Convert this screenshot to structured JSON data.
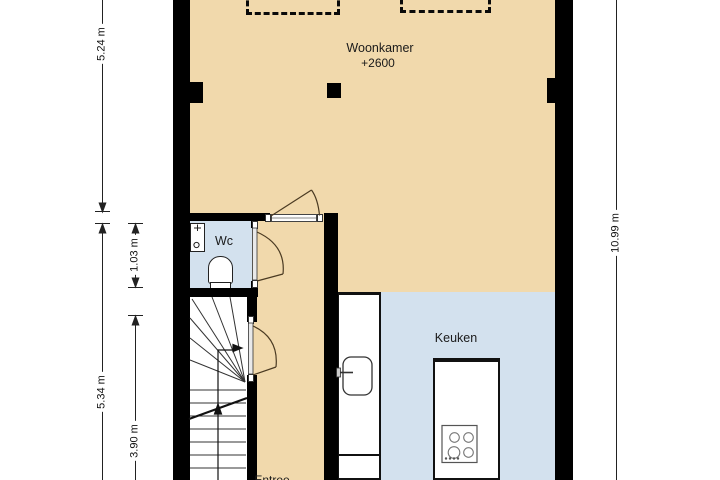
{
  "plan": {
    "rooms": {
      "woonkamer": {
        "label": "Woonkamer",
        "level_height": "+2600"
      },
      "wc": {
        "label": "Wc"
      },
      "keuken": {
        "label": "Keuken"
      },
      "entree": {
        "label": "Entree"
      }
    },
    "dimensions": {
      "left_top": "5.24 m",
      "left_bottom": "5.34 m",
      "inner_top": "1.03 m",
      "inner_bottom": "3.90 m",
      "right_full": "10.99 m"
    },
    "colors": {
      "living_floor": "#f1d9ac",
      "wet_room_floor": "#d3e1ee",
      "stair_floor": "#ffffff",
      "wall": "#000000",
      "door_swing": "#4a3a22",
      "dimension_line": "#222222"
    }
  }
}
